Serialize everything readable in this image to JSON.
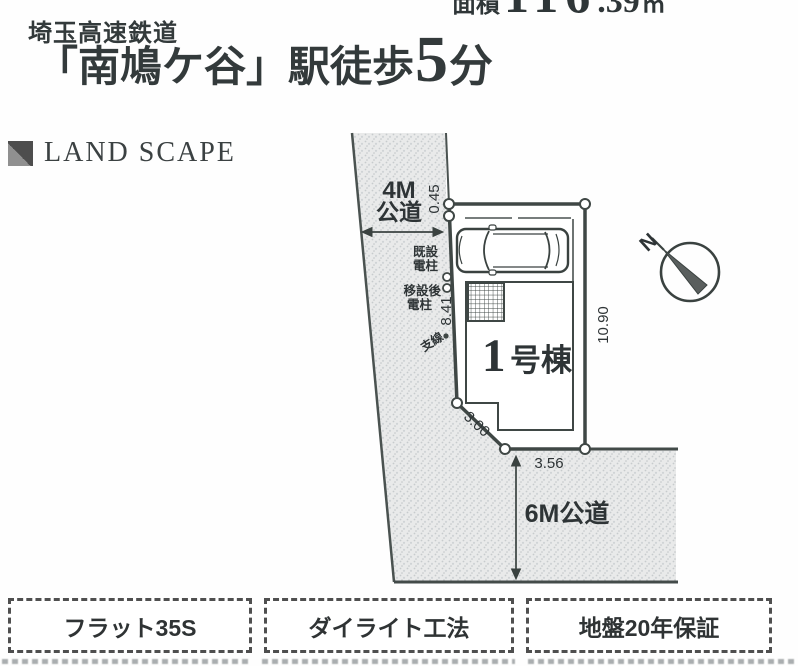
{
  "header": {
    "railway_line": "埼玉高速鉄道",
    "station_walk": "「南鳩ケ谷」駅徒歩",
    "walk_minutes": "5",
    "minutes_unit": "分",
    "area_label": "面積",
    "area_integer": "116",
    "area_decimal": ".39",
    "area_unit": "㎡"
  },
  "section_title": "LAND SCAPE",
  "site_plan": {
    "west_road_line1": "4M",
    "west_road_line2": "公道",
    "south_road_label": "6M公道",
    "building_number": "1",
    "building_suffix": "号棟",
    "dims": {
      "offset_top": "0.45",
      "west_edge": "8.41",
      "east_edge": "10.90",
      "sw_edge": "3.00",
      "south_edge": "3.56"
    },
    "annotations": {
      "existing_pole_l1": "既設",
      "existing_pole_l2": "電柱",
      "relocated_pole_l1": "移設後",
      "relocated_pole_l2": "電柱",
      "guy_wire": "支線"
    },
    "compass_n": "N"
  },
  "badges": [
    {
      "label": "フラット35S"
    },
    {
      "label": "ダイライト工法"
    },
    {
      "label": "地盤20年保証"
    }
  ],
  "colors": {
    "ink": "#343c3b",
    "road_fill": "#e9eaea",
    "road_dot": "#c7cbcd",
    "paper": "#fefefe"
  }
}
